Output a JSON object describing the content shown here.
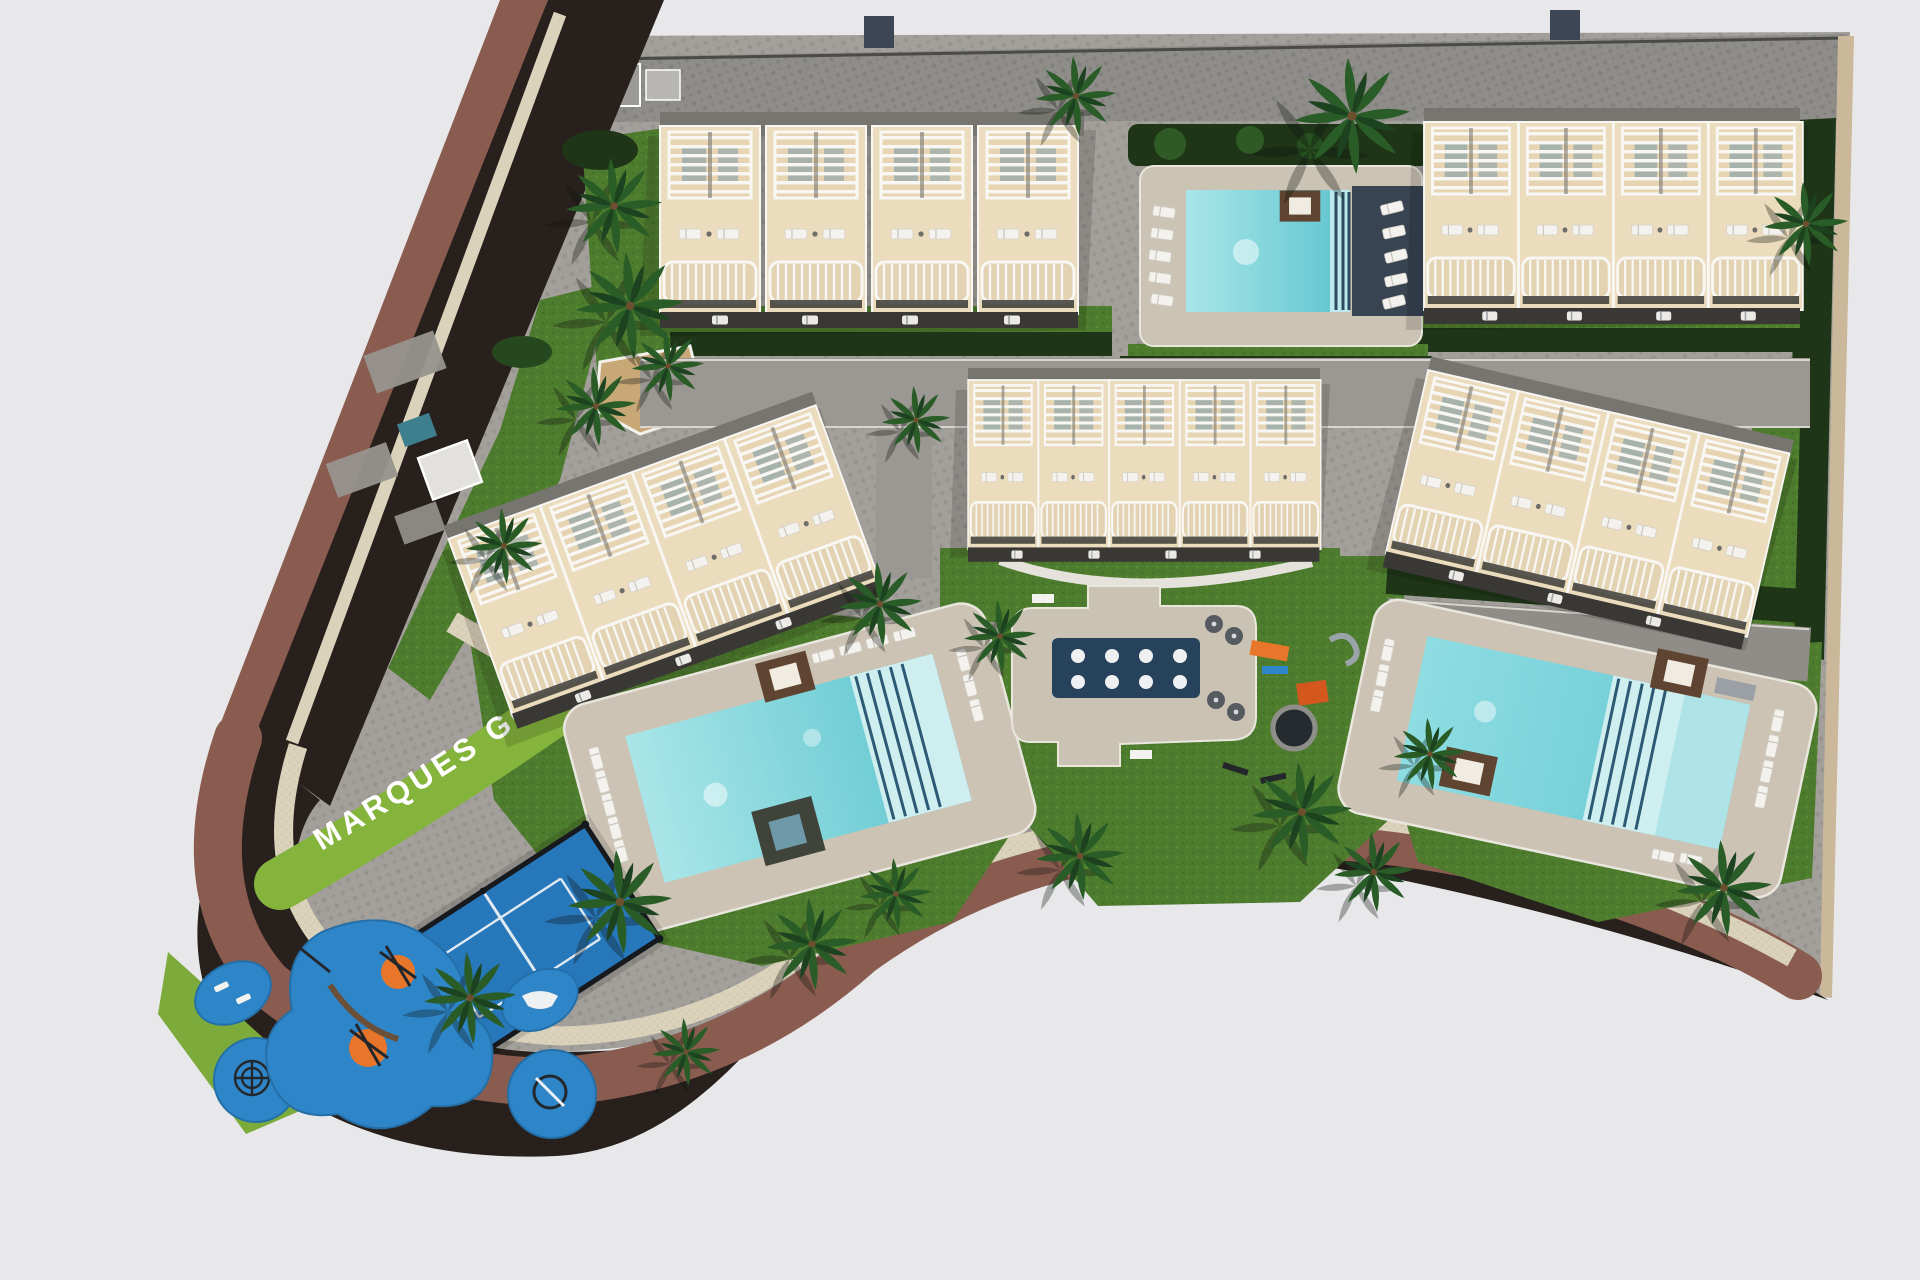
{
  "site": {
    "sign_text": "MARQUES GOLF",
    "development_name": "MARQUES GOLF",
    "view": "aerial-top-down-3d-render"
  },
  "scene": {
    "residential_blocks": 5,
    "townhouse_style": "cream rooftop terraces with white pergola slats and curved balconies",
    "swimming_pools": 3,
    "splash_reflecting_pool": 1,
    "splash_pool_jets": 8,
    "padel_court": 1,
    "children_playground_pads": 5,
    "playground_orange_pads": 2,
    "background": "light gray ground"
  },
  "palette": {
    "background": "#e8e8ea",
    "paving_gray": "#a3a09b",
    "perimeter_road_gray": "#8f8d89",
    "road_brown": "#8a5c50",
    "road_shadow": "#27201c",
    "sidewalk_beige": "#dbd2bc",
    "grass_green": "#4e7c2e",
    "hedge_dark_green": "#1e3617",
    "pool_turquoise": "#7fd4da",
    "pool_light": "#c9edef",
    "navy_deck": "#394452",
    "splash_pool_navy": "#27435c",
    "building_cream": "#ecdcbe",
    "building_white": "#f8f7f4",
    "roof_gray": "#77756f",
    "court_blue": "#2777bb",
    "playground_blue": "#2e86c9",
    "playground_orange": "#e8762a",
    "daybed_brown": "#5f4531",
    "wall_tan": "#cbb89a",
    "sign_band_green": "#85b43d",
    "sign_text_color": "#ffffff"
  }
}
